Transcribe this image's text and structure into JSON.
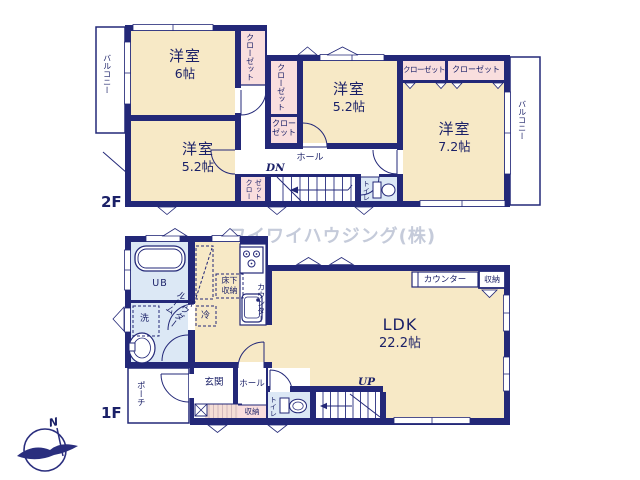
{
  "watermark": {
    "text": "ワイワイハウジング(株)",
    "color": "#c5cbda"
  },
  "colors": {
    "wall_navy": "#232878",
    "room_cream": "#f7e9c6",
    "closet_pink": "#f9dede",
    "bath_blue": "#dce8f5",
    "text_navy": "#1b2168",
    "watermark_gray": "#c5cbda"
  },
  "compass": {
    "north": "N"
  },
  "floor2": {
    "label": "2F",
    "rooms": {
      "bed6": {
        "name": "洋室",
        "size": "6帖"
      },
      "bed52_left": {
        "name": "洋室",
        "size": "5.2帖"
      },
      "bed52_mid": {
        "name": "洋室",
        "size": "5.2帖"
      },
      "bed72": {
        "name": "洋室",
        "size": "7.2帖"
      }
    },
    "labels": {
      "balcony_left": "バルコニー",
      "balcony_right": "バルコニー",
      "closet_a": "クローゼット",
      "closet_b": "クローゼット",
      "closet_c": "クロー\nゼット",
      "closet_d": "クロー\nゼット",
      "closet_e": "クローゼット",
      "closet_f": "クローゼット",
      "hall": "ホール",
      "stairs_down": "DN",
      "toilet": "トイレ"
    }
  },
  "floor1": {
    "label": "1F",
    "rooms": {
      "ldk": {
        "name": "LDK",
        "size": "22.2帖"
      }
    },
    "labels": {
      "unit_bath": "UB",
      "washer": "洗",
      "powder_room": "パウダー\nルーム",
      "underfloor_storage": "床下\n収納",
      "fridge": "冷",
      "kitchen_counter": "カウンター",
      "ldk_counter": "カウンター",
      "ldk_storage": "収納",
      "entrance": "玄関",
      "hall": "ホール",
      "entrance_storage": "収納",
      "toilet": "トイレ",
      "porch": "ポーチ",
      "stairs_up": "UP"
    }
  }
}
